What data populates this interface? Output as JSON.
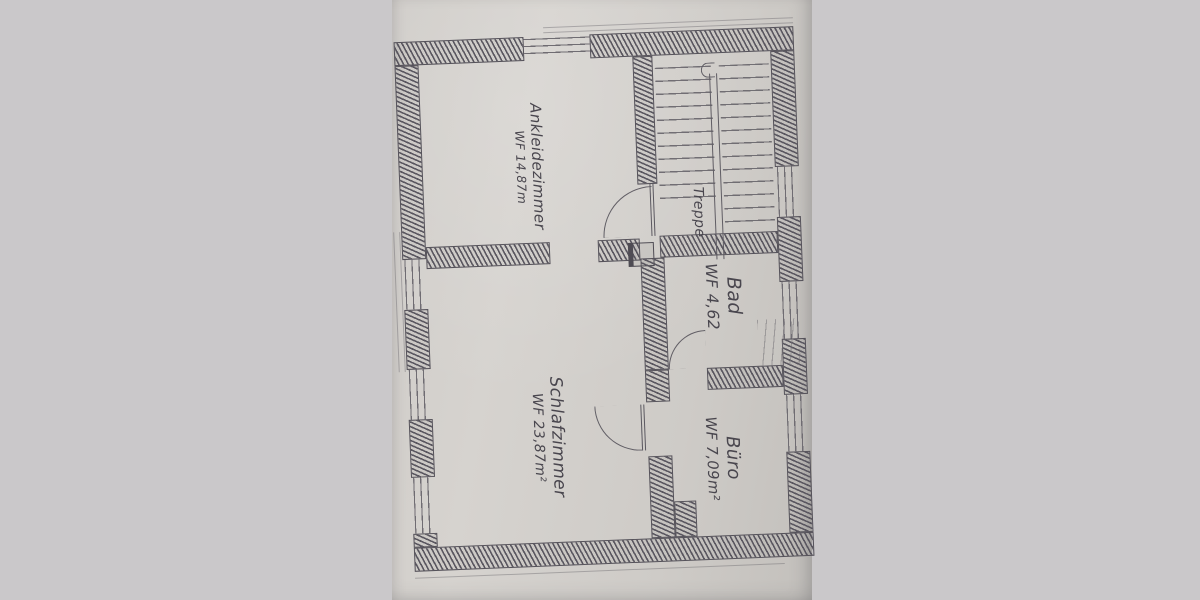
{
  "rooms": [
    {
      "name": "Ankleidezimmer",
      "area": "WF 14,87m"
    },
    {
      "name": "Treppe",
      "area": ""
    },
    {
      "name": "Bad",
      "area": "WF 4,62"
    },
    {
      "name": "Schlafzimmer",
      "area": "WF 23,87m²"
    },
    {
      "name": "Büro",
      "area": "WF 7,09m²"
    }
  ],
  "colors": {
    "paper": "#d2cfca",
    "backdrop": "#c9c7c9",
    "pencil": "#55525a"
  }
}
